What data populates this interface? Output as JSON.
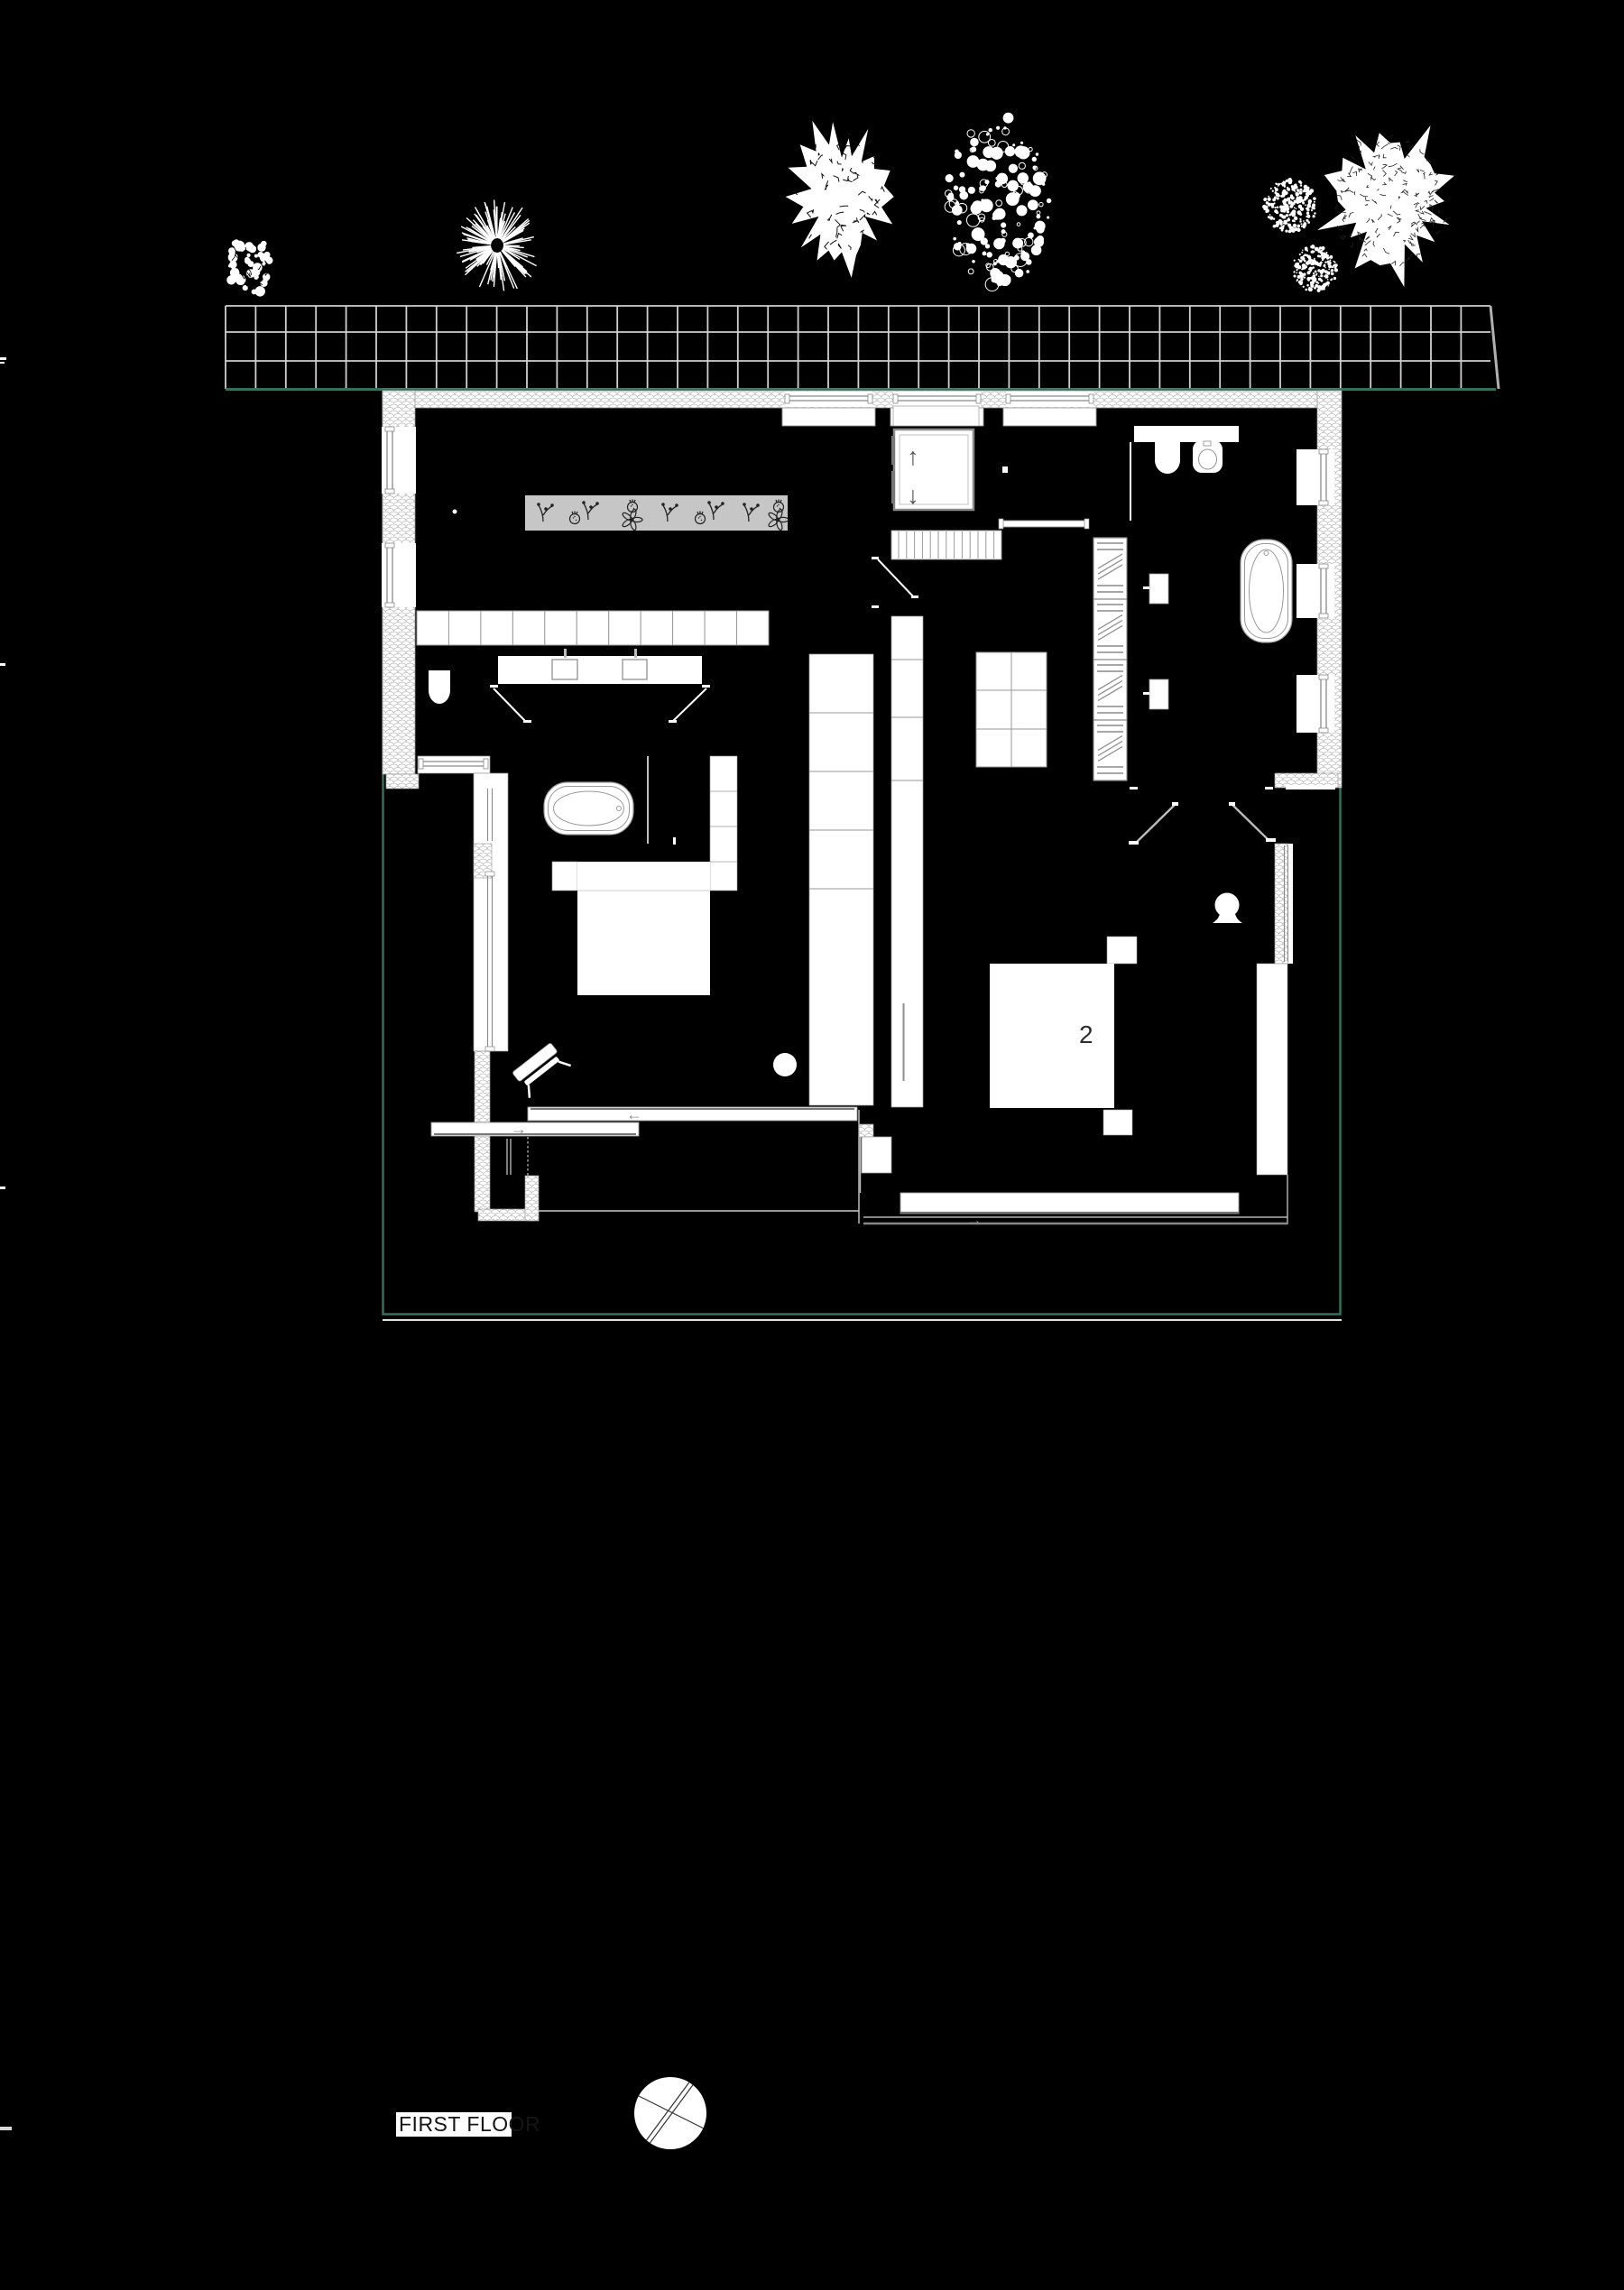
{
  "title": {
    "floor_label": "FIRST FLOOR"
  },
  "plan": {
    "room_number": "2",
    "arrows": {
      "up": "↑",
      "down": "↓",
      "left": "←",
      "right": "→"
    },
    "colors": {
      "background": "#000000",
      "drawing_white": "#FFFFFF",
      "site_boundary_green": "#33715A",
      "planter_gray": "#C6C6C6",
      "detail_gray": "#999999",
      "paving_line": "#D0D0D0"
    }
  }
}
